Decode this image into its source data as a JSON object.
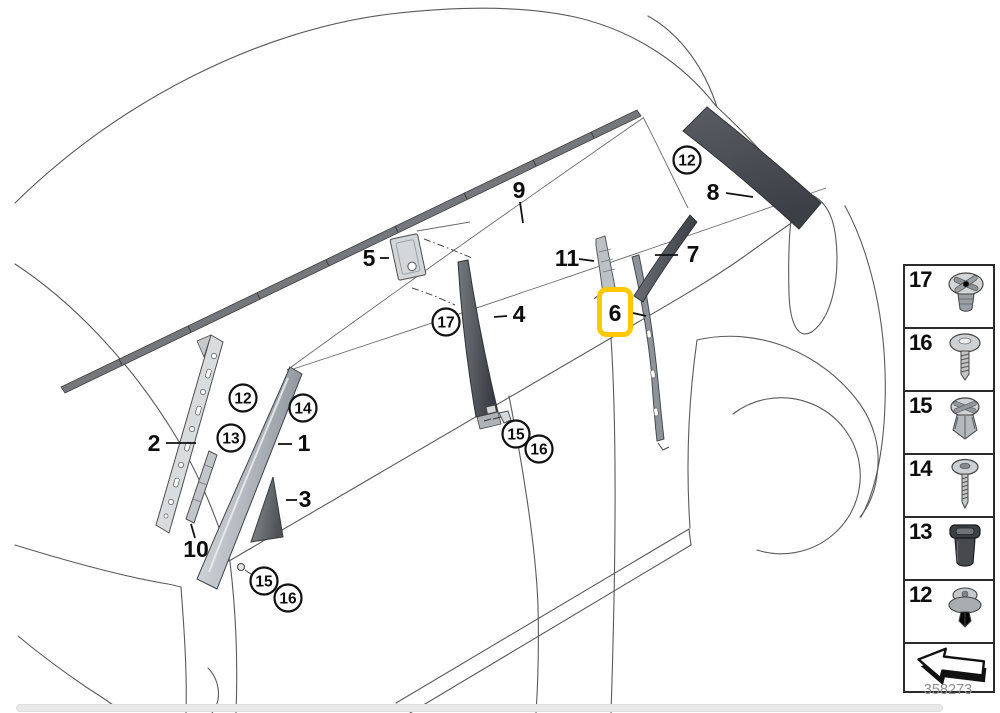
{
  "diagram": {
    "drawing_number": "358273",
    "highlighted_part": "6",
    "highlight_color": "#FFC800",
    "callouts": {
      "plain": [
        {
          "label": "1"
        },
        {
          "label": "2"
        },
        {
          "label": "3"
        },
        {
          "label": "4"
        },
        {
          "label": "5"
        },
        {
          "label": "6"
        },
        {
          "label": "7"
        },
        {
          "label": "8"
        },
        {
          "label": "9"
        },
        {
          "label": "10"
        },
        {
          "label": "11"
        }
      ],
      "circled": [
        {
          "label": "12"
        },
        {
          "label": "12"
        },
        {
          "label": "13"
        },
        {
          "label": "14"
        },
        {
          "label": "17"
        },
        {
          "label": "15"
        },
        {
          "label": "16"
        },
        {
          "label": "15"
        },
        {
          "label": "16"
        }
      ]
    },
    "legend": {
      "items": [
        {
          "number": "17",
          "icon": "grommet-nut-icon"
        },
        {
          "number": "16",
          "icon": "washer-head-screw-icon"
        },
        {
          "number": "15",
          "icon": "expanding-rivet-icon"
        },
        {
          "number": "14",
          "icon": "screw-with-washer-icon"
        },
        {
          "number": "13",
          "icon": "rubber-plug-icon"
        },
        {
          "number": "12",
          "icon": "push-rivet-icon"
        }
      ],
      "direction_arrow_icon": "direction-arrow-icon"
    }
  }
}
